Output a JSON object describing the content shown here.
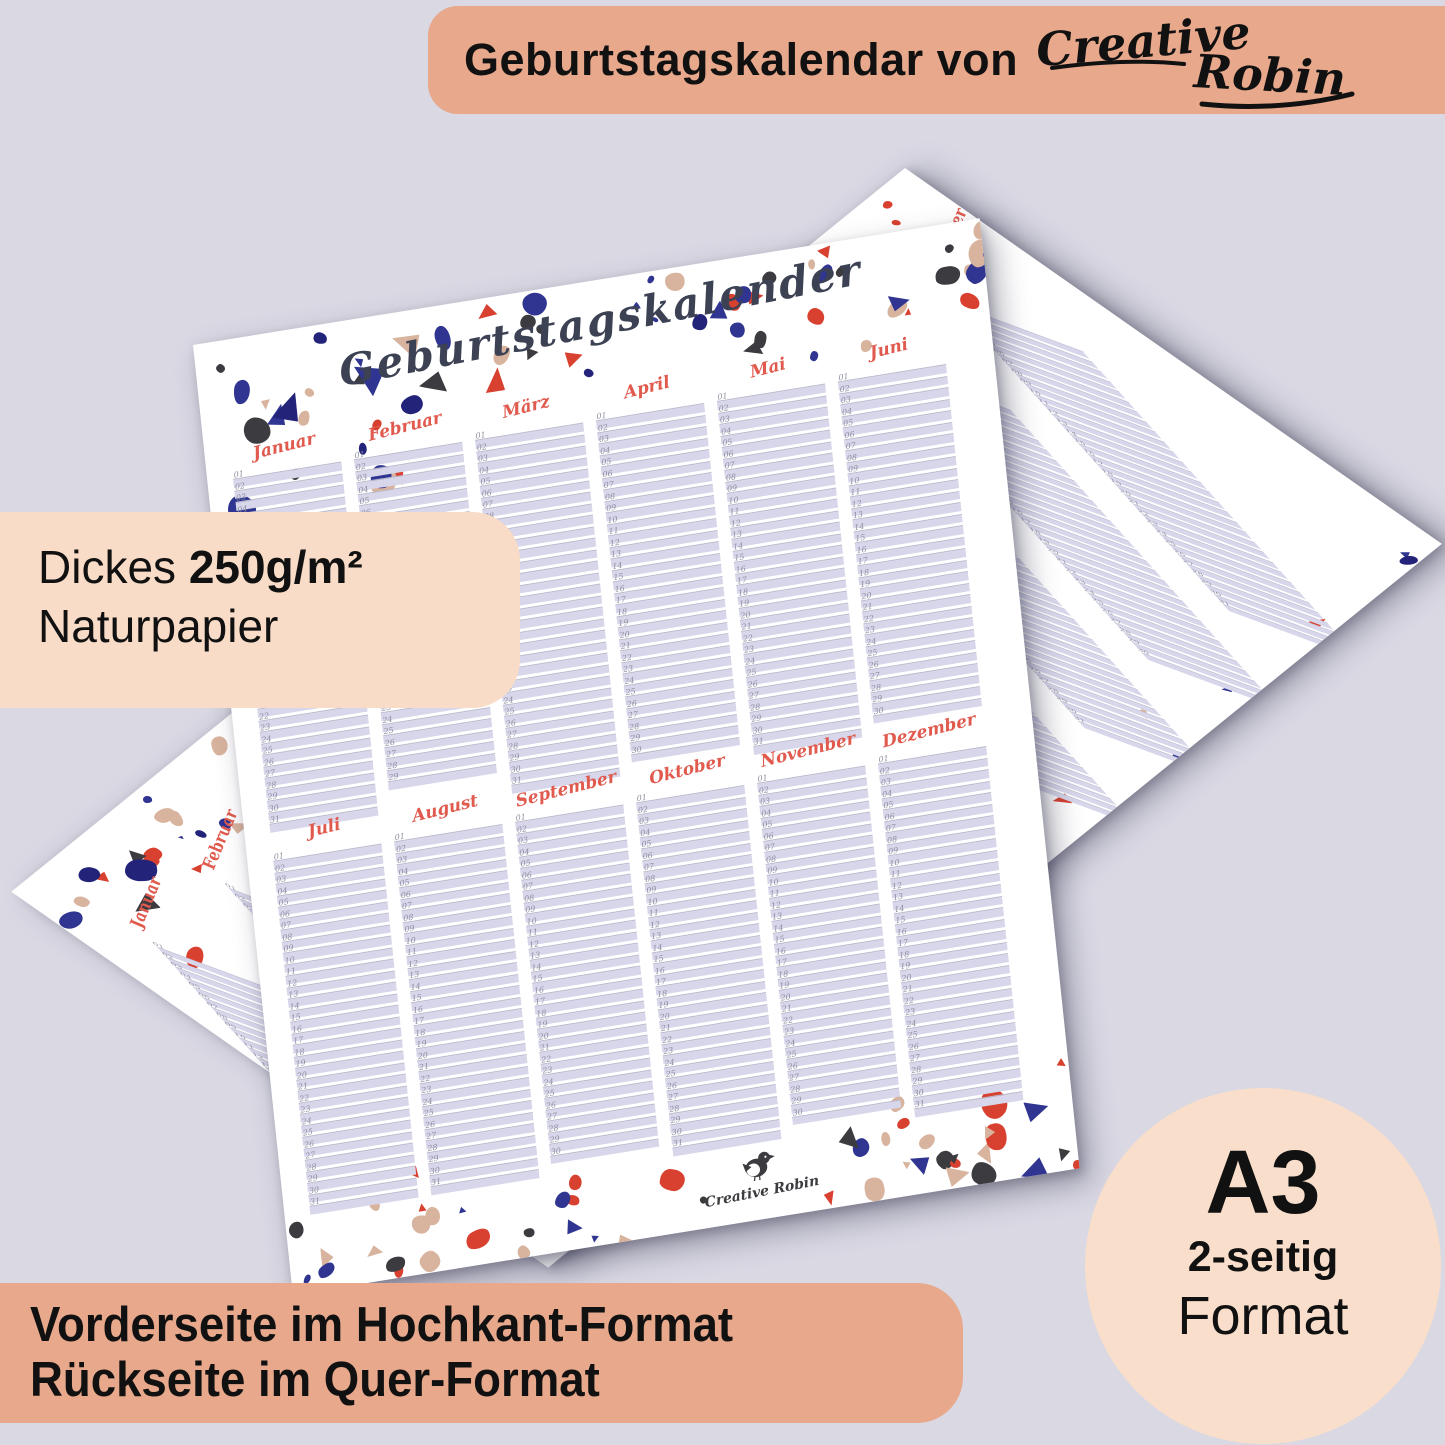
{
  "top_banner": {
    "label": "Geburtstagskalendar von",
    "brand": {
      "first": "Creative",
      "second": "Robin"
    }
  },
  "paper_badge": {
    "lead": "Dickes",
    "weight": "250g/m²",
    "line2": "Naturpapier"
  },
  "format_banner": {
    "line1": "Vorderseite im Hochkant-Format",
    "line2": "Rückseite im Quer-Format"
  },
  "format_circle": {
    "size": "A3",
    "sides": "2-seitig",
    "word": "Format"
  },
  "calendar": {
    "title": "Geburtstagskalender",
    "brand_logo": "Creative Robin",
    "months": [
      "Januar",
      "Februar",
      "März",
      "April",
      "Mai",
      "Juni",
      "Juli",
      "August",
      "September",
      "Oktober",
      "November",
      "Dezember"
    ],
    "days_in_month": [
      31,
      29,
      31,
      30,
      31,
      30,
      31,
      31,
      30,
      31,
      30,
      31
    ]
  },
  "colors": {
    "background": "#d9d8e3",
    "banner": "#e8a88b",
    "badge": "#f8dcc7",
    "circle": "#f8decb",
    "paper": "#ffffff",
    "row_bar": "#d7d6ea",
    "row_line": "#b9b8cb",
    "month_label": "#e05a4e",
    "title_ink": "#3c4254",
    "number_ink": "#8e8e9f",
    "terrazzo": [
      "#d8402f",
      "#2f3590",
      "#d8b49e",
      "#3b3b40",
      "#23237a"
    ]
  }
}
